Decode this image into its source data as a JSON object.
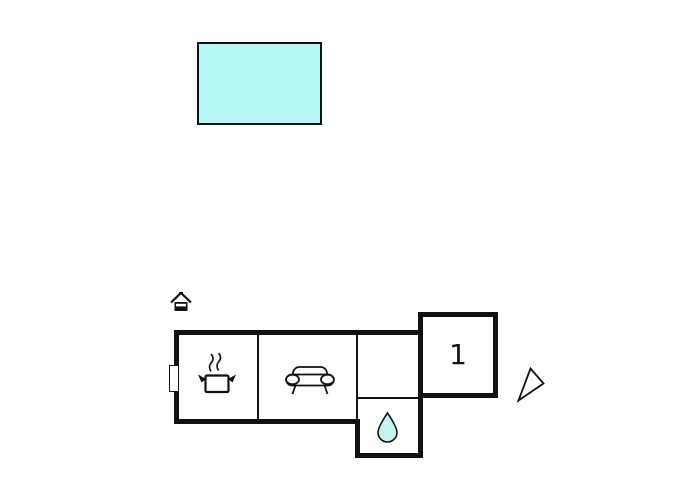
{
  "scene": {
    "type": "property-floorplan-with-pool",
    "background": "#ffffff"
  },
  "colors": {
    "wall": "#111111",
    "icon_stroke": "#111111",
    "pool_fill": "#b5f8f5",
    "drop_fill": "#c2f5f2"
  },
  "pool": {
    "name": "swimming-pool"
  },
  "floorplan": {
    "bedroom": {
      "label": "1"
    },
    "icons": {
      "marker": "house-icon",
      "kitchen": "cooking-pot-icon",
      "living_room": "sofa-icon",
      "bathroom": "water-drop-icon",
      "direction": "direction-arrow-icon"
    }
  }
}
